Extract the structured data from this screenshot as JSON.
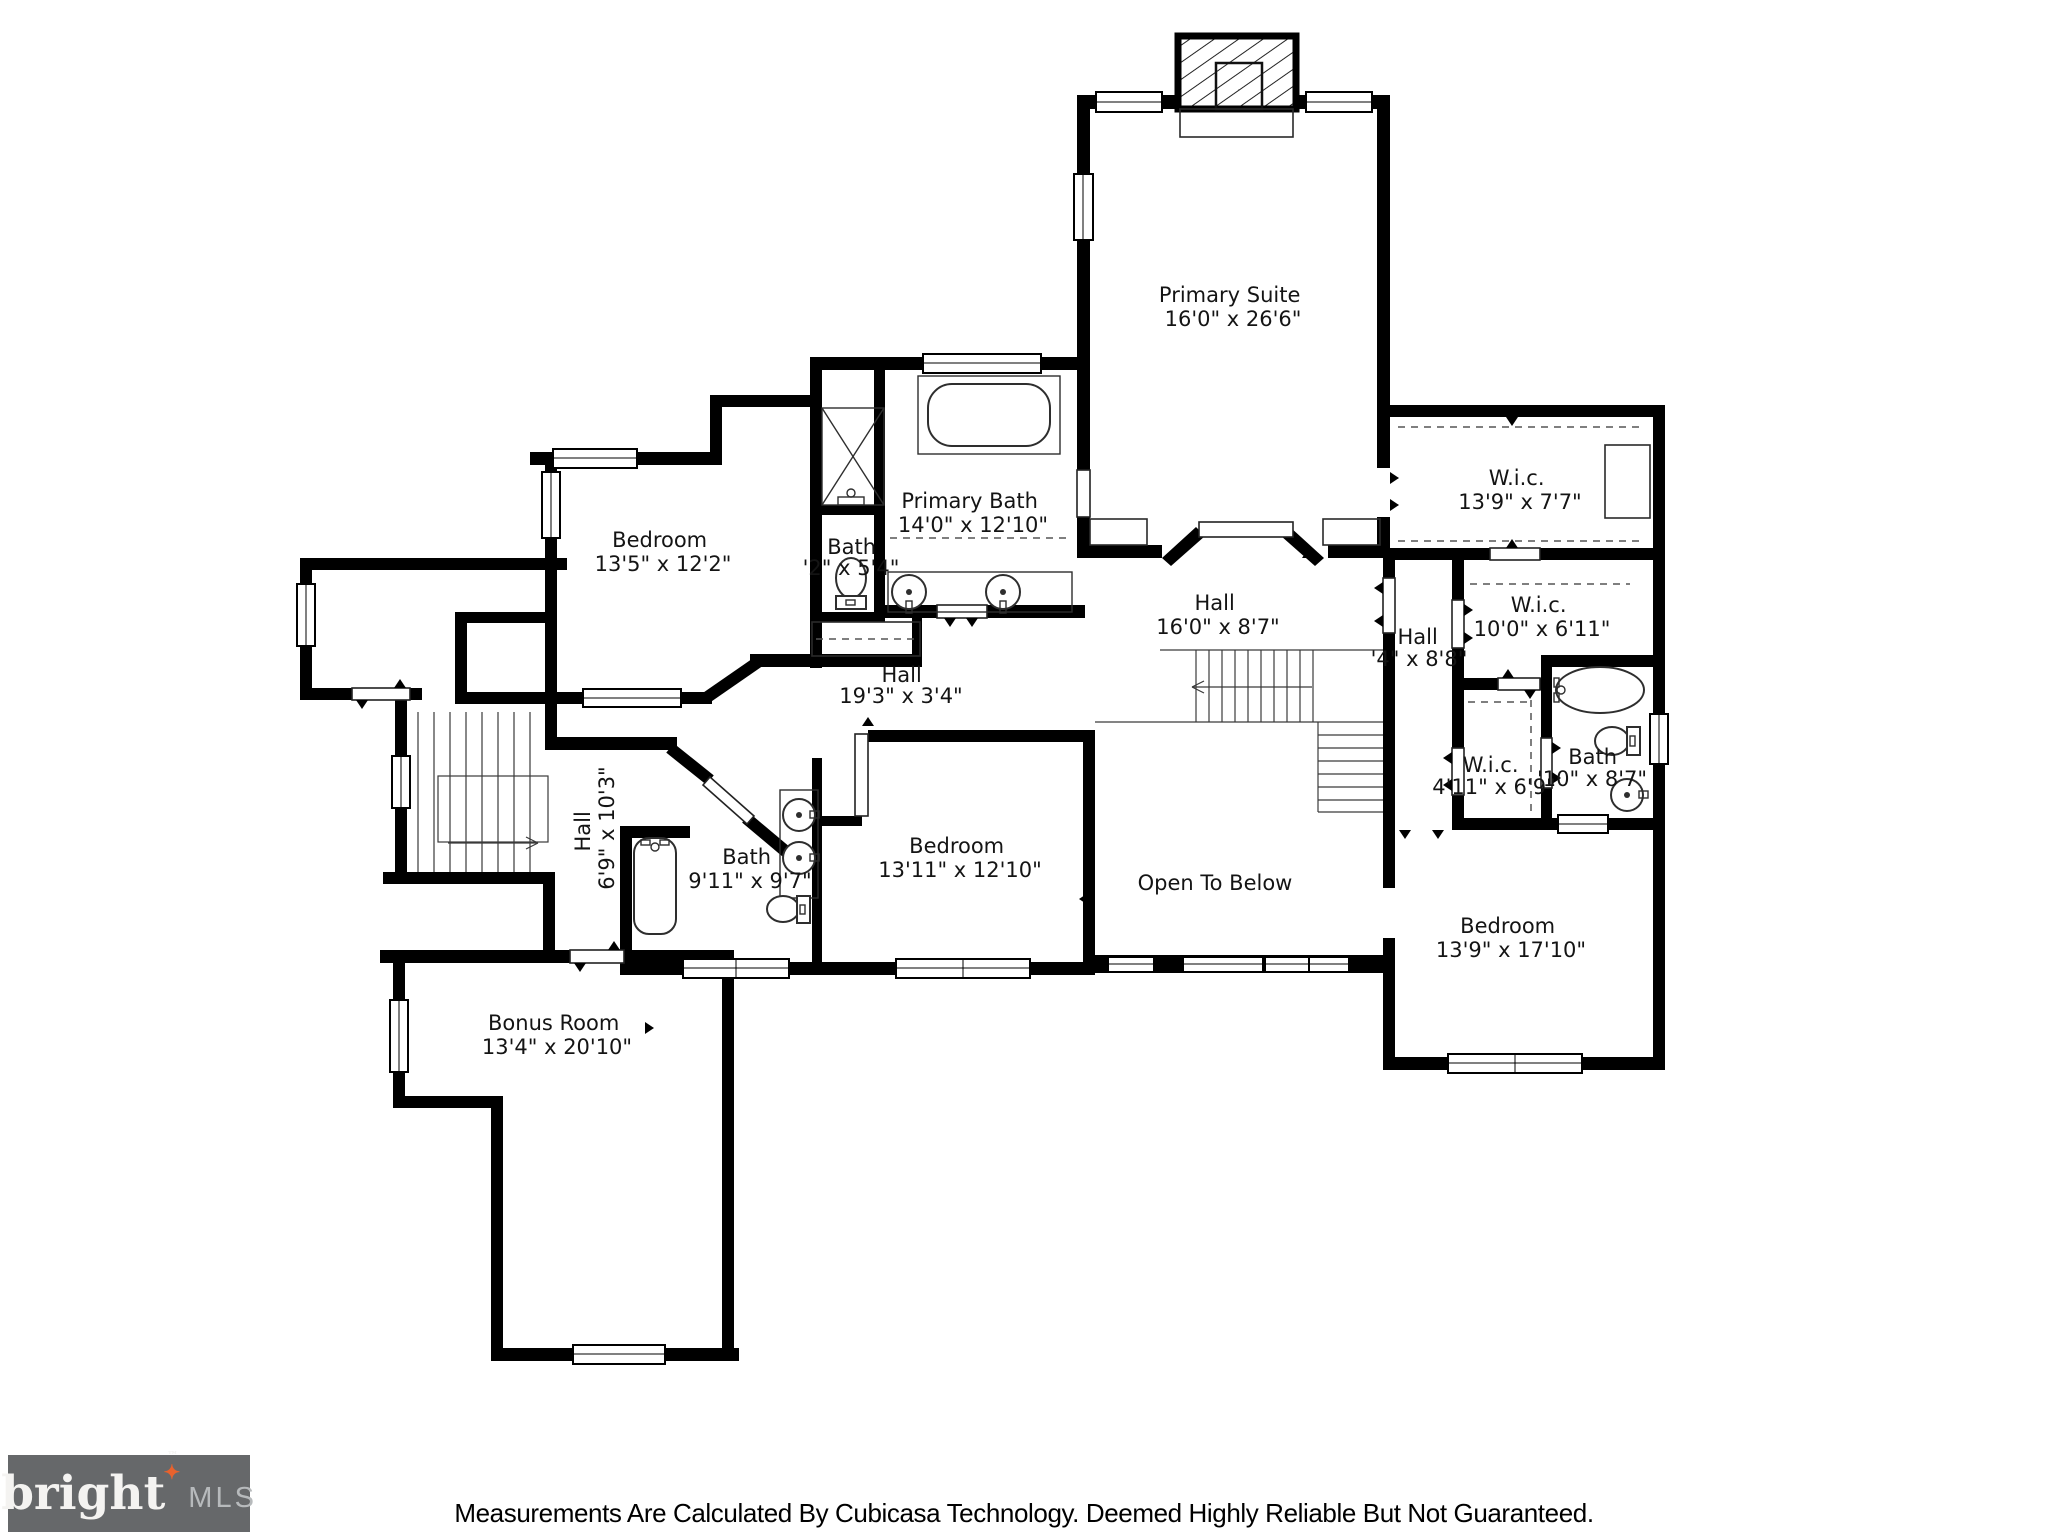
{
  "footer": {
    "logo": {
      "brand": "bright",
      "tm": "™",
      "suffix": "MLS",
      "bg_color": "#66686A",
      "brand_color": "#F4F3F1",
      "suffix_color": "#B7BABC",
      "star": "✦",
      "star_color": "#E8622D"
    },
    "disclaimer": "Measurements Are Calculated By Cubicasa Technology. Deemed Highly Reliable But Not Guaranteed."
  },
  "floorplan": {
    "wall_color": "#000000",
    "rooms": [
      {
        "id": "primary-suite",
        "name": "Primary Suite",
        "dims": "16'0\" x 26'6\""
      },
      {
        "id": "wic-top",
        "name": "W.i.c.",
        "dims": "13'9\" x 7'7\""
      },
      {
        "id": "bedroom-left",
        "name": "Bedroom",
        "dims": "13'5\" x 12'2\""
      },
      {
        "id": "bath-small",
        "name": "Bath",
        "dims": "'2\" x 5'4\""
      },
      {
        "id": "primary-bath",
        "name": "Primary Bath",
        "dims": "14'0\" x 12'10\""
      },
      {
        "id": "hall-center",
        "name": "Hall",
        "dims": "16'0\" x 8'7\""
      },
      {
        "id": "hall-right",
        "name": "Hall",
        "dims": "'4\" x 8'8\""
      },
      {
        "id": "wic-right",
        "name": "W.i.c.",
        "dims": "10'0\" x 6'11\""
      },
      {
        "id": "hall-long",
        "name": "Hall",
        "dims": "19'3\" x 3'4\""
      },
      {
        "id": "hall-left",
        "name": "Hall",
        "dims": "6'9\" x 10'3\""
      },
      {
        "id": "bath-middle",
        "name": "Bath",
        "dims": "9'11\" x 9'7\""
      },
      {
        "id": "bedroom-middle",
        "name": "Bedroom",
        "dims": "13'11\" x 12'10\""
      },
      {
        "id": "open-below",
        "name": "Open To Below",
        "dims": ""
      },
      {
        "id": "wic-small",
        "name": "W.i.c.",
        "dims": "4'11\" x 6'9\""
      },
      {
        "id": "bath-right",
        "name": "Bath",
        "dims": "'10\" x 8'7\""
      },
      {
        "id": "bedroom-right",
        "name": "Bedroom",
        "dims": "13'9\" x 17'10\""
      },
      {
        "id": "bonus-room",
        "name": "Bonus Room",
        "dims": "13'4\" x 20'10\""
      }
    ]
  }
}
